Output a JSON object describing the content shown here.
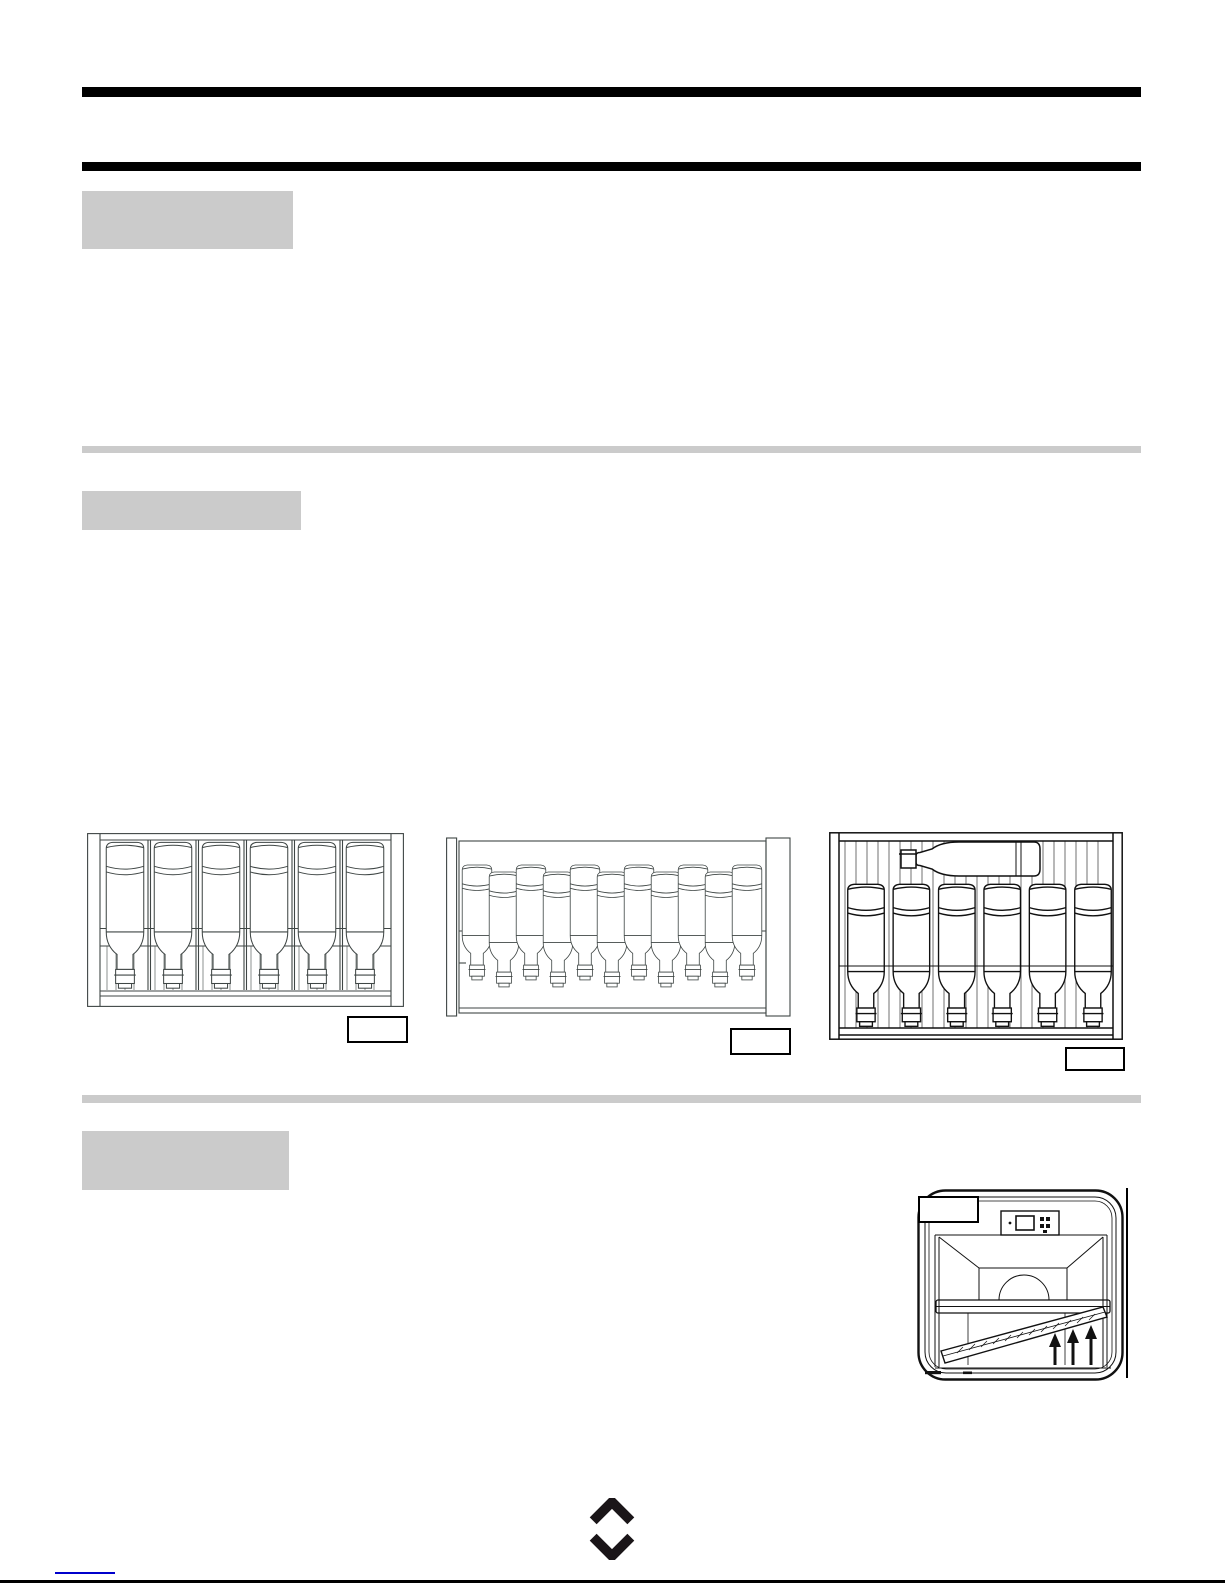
{
  "document": {
    "kind": "wine-cooler manual page (scanned, text not rendered)",
    "visible_text": []
  },
  "colors": {
    "page_background": "#ffffff",
    "heading_rule_black": "#000000",
    "heading_block_gray": "#cbcbcb",
    "drawing_line_dark": "#3f4645",
    "drawing_line_black": "#111111",
    "footer_link_blue": "#0000cc"
  },
  "sections": {
    "heading_block_1_label": "",
    "heading_block_2_label": "",
    "heading_block_3_label": ""
  },
  "figures": {
    "rack_spaced": {
      "bottle_count": 6,
      "orientation": "bottles inverted, spaced with dividers",
      "label": ""
    },
    "rack_dense": {
      "bottle_count": 11,
      "orientation": "bottles inverted, densely interleaved",
      "label": ""
    },
    "rack_with_horizontal_bottle": {
      "bottle_count": 7,
      "orientation": "6 inverted bottles + 1 horizontal bottle on top",
      "label": ""
    },
    "cooler_interior": {
      "label": "",
      "up_arrow_count": 3,
      "features": [
        "control panel",
        "fan dome",
        "shelf",
        "tilted shelf being removed"
      ]
    }
  },
  "footer": {
    "link_text": "",
    "logo": "interlocking-diamond mark"
  }
}
